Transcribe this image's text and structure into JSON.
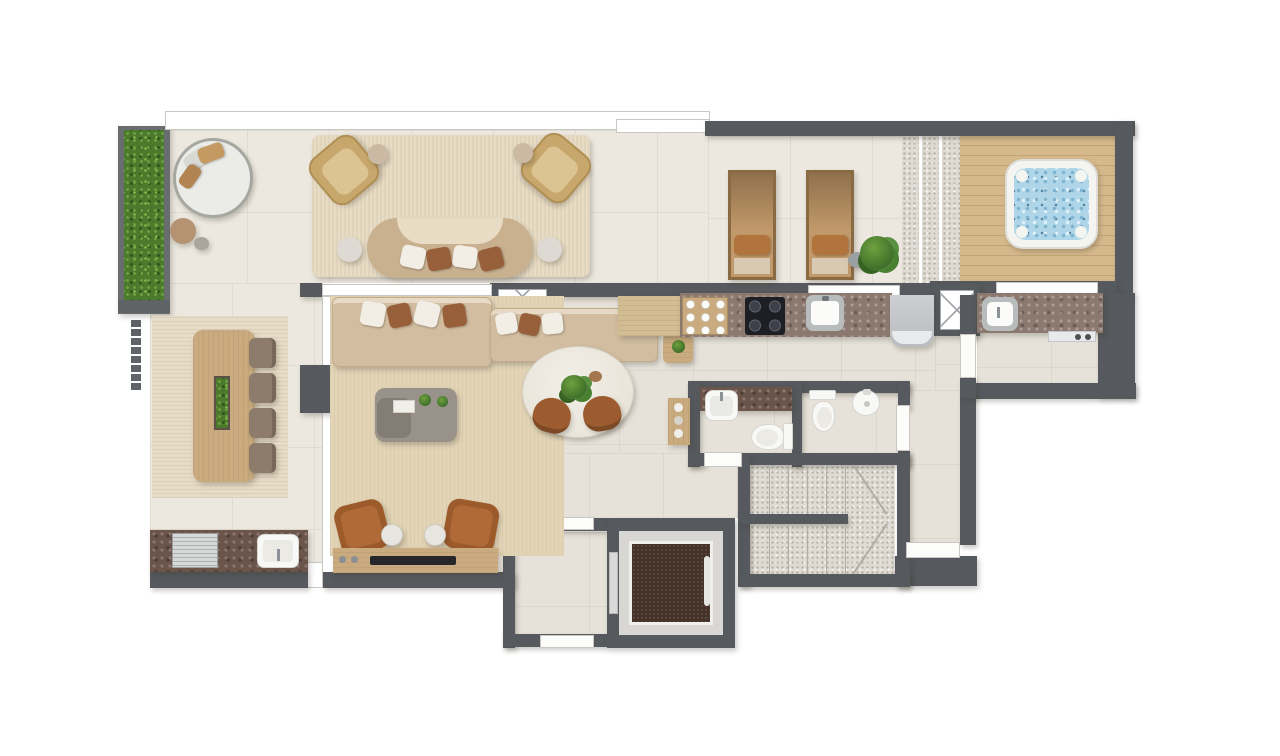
{
  "plan": {
    "type": "residential-floor-plan",
    "view": "top-down-render",
    "visible_text": [],
    "rooms": [
      {
        "id": "terrace-lounge",
        "name": "outdoor lounge terrace"
      },
      {
        "id": "green-wall",
        "name": "vertical garden"
      },
      {
        "id": "sun-deck",
        "name": "sun lounger deck"
      },
      {
        "id": "jacuzzi-deck",
        "name": "wood deck with jacuzzi"
      },
      {
        "id": "outdoor-dining",
        "name": "terrace dining"
      },
      {
        "id": "outdoor-kitchen",
        "name": "terrace bbq counter"
      },
      {
        "id": "living-room",
        "name": "living room"
      },
      {
        "id": "dining-area",
        "name": "interior dining"
      },
      {
        "id": "kitchen",
        "name": "kitchen"
      },
      {
        "id": "laundry",
        "name": "laundry / utility room"
      },
      {
        "id": "bathroom-1",
        "name": "bathroom with vanity"
      },
      {
        "id": "bathroom-2",
        "name": "toilet room"
      },
      {
        "id": "staircase",
        "name": "u-shaped staircase"
      },
      {
        "id": "elevator",
        "name": "elevator"
      },
      {
        "id": "elevator-lobby",
        "name": "elevator vestibule"
      },
      {
        "id": "corridor",
        "name": "corridor"
      }
    ],
    "furniture": [
      "round-daybed",
      "pouf",
      "wicker-armchair",
      "curved-sofa",
      "side-table",
      "area-rug",
      "sun-lounger",
      "monstera-plant",
      "jacuzzi",
      "long-dining-table",
      "dining-chair",
      "bbq-grill",
      "outdoor-sink",
      "l-sofa",
      "coffee-table",
      "leather-armchair",
      "tv-console",
      "oval-dining-table",
      "coffee-station",
      "cooktop",
      "kitchen-sink",
      "fridge",
      "duct-shaft",
      "laundry-counter",
      "laundry-sink",
      "vanity-sink",
      "toilet",
      "bidet",
      "bar-shelf",
      "stairs",
      "elevator-car",
      "handrail"
    ]
  },
  "palette": {
    "wall": "#56595d",
    "floorIn": "#e6e2d9",
    "floorOut": "#ece8df",
    "rug": "#e8dcc4",
    "rugLiving": "#e3d4b6",
    "rugStripe": "#e7dcc6",
    "wood": "#c9ab7f",
    "woodLight": "#d2bc92",
    "deck": "#d5b98c",
    "deckLine": "#c3a479",
    "sofa": "#d2bda0",
    "sofaEdge": "#c2ab8a",
    "pillowWhite": "#f2eee6",
    "pillowBrown": "#98603a",
    "wicker": "#c8a76c",
    "leather": "#9d5a2b",
    "chairBrown": "#9c5c30",
    "chairGray": "#8d7c6b",
    "counter": "#8b7970",
    "counterDark": "#6b554a",
    "steel": "#c6c8c8",
    "green": "#4c7a2c",
    "greenLight": "#6fa03f",
    "water": "#aed6e8",
    "gravel": "#dfdbd3",
    "carpet": "#42322a",
    "fixture": "#f8f8f6",
    "fixtureEdge": "#d8d6d1",
    "stoneTable": "#98928a",
    "marbleTable": "#f2efe8"
  }
}
